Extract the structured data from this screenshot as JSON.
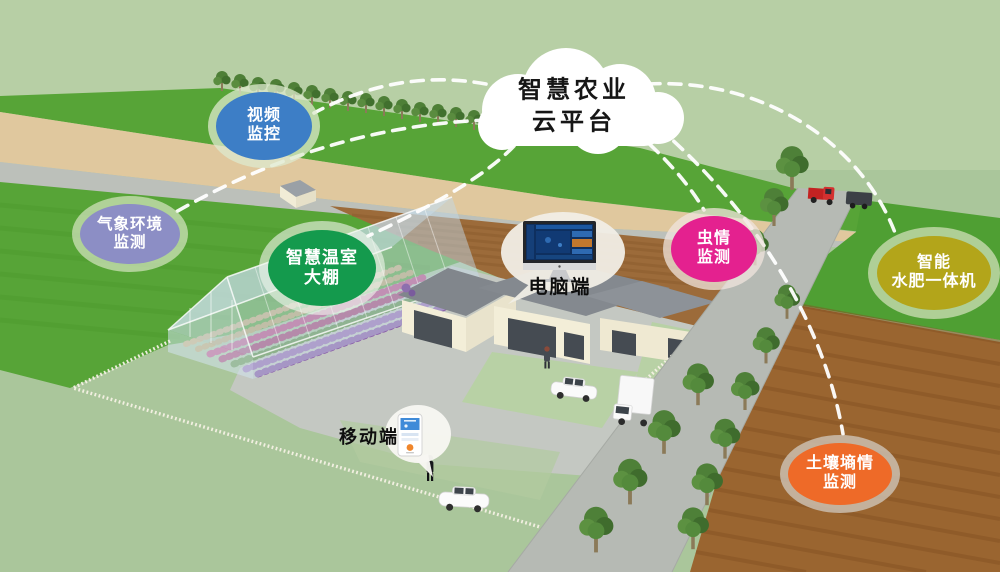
{
  "cloud": {
    "line1": "智慧农业",
    "line2": "云平台",
    "fill": "#ffffff",
    "text_color": "#161616"
  },
  "nodes": [
    {
      "id": "video-monitoring",
      "lines": [
        "视频",
        "监控"
      ],
      "color": "#3d7ec6"
    },
    {
      "id": "weather-environment-monitoring",
      "lines": [
        "气象环境",
        "监测"
      ],
      "color": "#8c8ec5"
    },
    {
      "id": "smart-greenhouse",
      "lines": [
        "智慧温室",
        "大棚"
      ],
      "color": "#149a4d"
    },
    {
      "id": "pest-monitoring",
      "lines": [
        "虫情",
        "监测"
      ],
      "color": "#e4218f"
    },
    {
      "id": "smart-fertigation-machine",
      "lines": [
        "智能",
        "水肥一体机"
      ],
      "color": "#b3a51a"
    },
    {
      "id": "soil-moisture-monitoring",
      "lines": [
        "土壤墒情",
        "监测"
      ],
      "color": "#ee6a28"
    }
  ],
  "terminals": {
    "pc": {
      "label": "电脑端"
    },
    "mobile": {
      "label": "移动端"
    }
  },
  "connections": {
    "color": "#ffffff",
    "dash": "12 9"
  },
  "palette": {
    "sky_field": "#b7cfa5",
    "sage_grass": "#aac69b",
    "bright_field": "#57a437",
    "tan_road": "#e0c89e",
    "country_road": "#b6bab4",
    "soil_brown": "#9a6530",
    "house_cream": "#f3eed8",
    "roof_gray": "#84898f",
    "greenhouse_glass": "#cfe2ec",
    "pc_screen": "#0e2f5f",
    "phone_header": "#3f8bd8"
  }
}
